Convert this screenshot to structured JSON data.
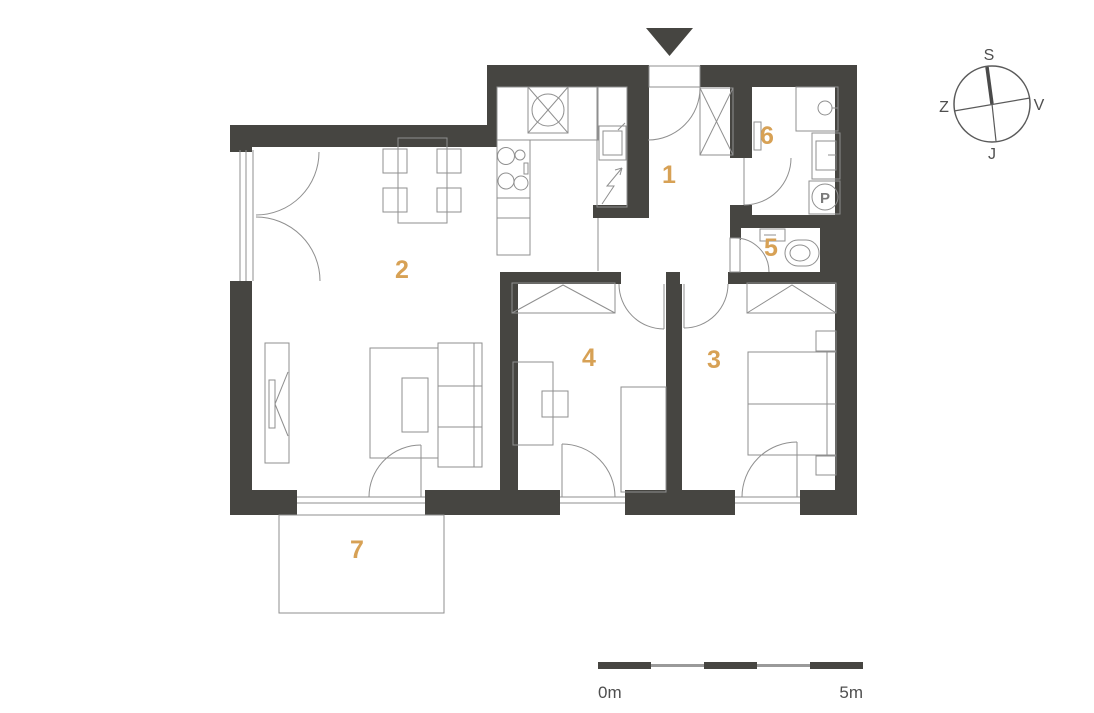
{
  "colors": {
    "wall": "#464541",
    "line": "#8f8f8f",
    "accent": "#d7a155",
    "labeltext": "#4f4f4f"
  },
  "rooms": [
    {
      "label": "1"
    },
    {
      "label": "2"
    },
    {
      "label": "3"
    },
    {
      "label": "4"
    },
    {
      "label": "5"
    },
    {
      "label": "6"
    },
    {
      "label": "7"
    }
  ],
  "compass": {
    "north": "S",
    "east": "V",
    "south": "J",
    "west": "Z"
  },
  "scale_bar": {
    "start_label": "0m",
    "end_label": "5m"
  },
  "fixtures": {
    "washing_machine_label": "P"
  }
}
